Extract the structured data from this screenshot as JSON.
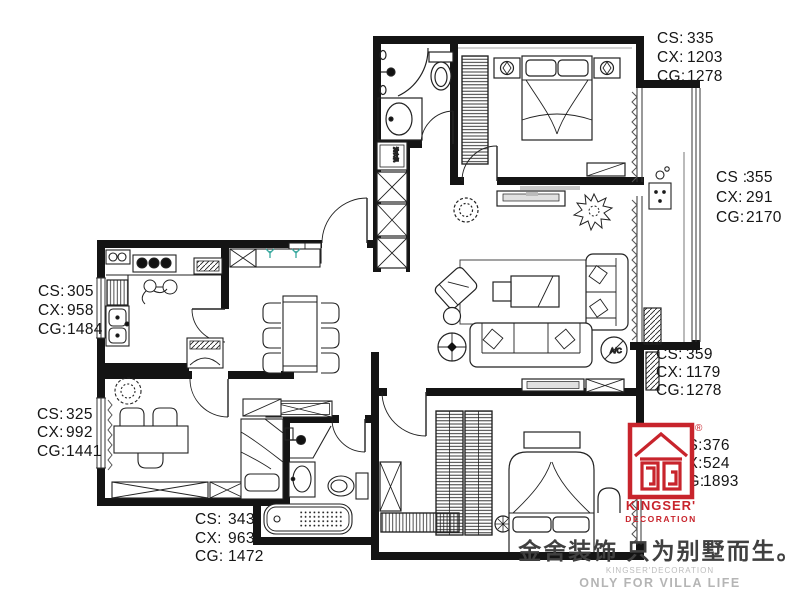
{
  "brand": {
    "registered_mark": "®",
    "logo_text_1": "KINGSER'",
    "logo_text_2": "DECORATION",
    "slogan_cn": "金舍装饰 只为别墅而生。",
    "slogan_en_1": "KINGSER'DECORATION",
    "slogan_en_2": "ONLY FOR VILLA LIFE"
  },
  "dimension_labels": {
    "top_right": {
      "row1_key": "CS:",
      "row1_val": "335",
      "row2_key": "CX:",
      "row2_val": "1203",
      "row3_key": "CG:",
      "row3_val": "1278"
    },
    "right_upper": {
      "row1_key": "CS :",
      "row1_val": "355",
      "row2_key": "CX:",
      "row2_val": "291",
      "row3_key": "CG:",
      "row3_val": "2170"
    },
    "right_lower": {
      "row1_key": "CS:",
      "row1_val": "359",
      "row2_key": "CX:",
      "row2_val": "1179",
      "row3_key": "CG:",
      "row3_val": "1278"
    },
    "logo_side": {
      "row1_key": "CS:",
      "row1_val": "376",
      "row2_key": "CX:",
      "row2_val": "524",
      "row3_key": "CG:",
      "row3_val": "1893"
    },
    "left_upper": {
      "row1_key": "CS:",
      "row1_val": "305",
      "row2_key": "CX:",
      "row2_val": "958",
      "row3_key": "CG:",
      "row3_val": "1484"
    },
    "left_lower": {
      "row1_key": "CS:",
      "row1_val": "325",
      "row2_key": "CX:",
      "row2_val": "992",
      "row3_key": "CG:",
      "row3_val": "1441"
    },
    "bottom": {
      "row1_key": "CS:",
      "row1_val": "343",
      "row2_key": "CX:",
      "row2_val": "963",
      "row3_key": "CG:",
      "row3_val": "1472"
    }
  },
  "plan_annotations": {
    "ac_label": "A/C",
    "washer_label": "洗衣机"
  },
  "colors": {
    "wall": "#141414",
    "line": "#222222",
    "logo_red": "#c8242c",
    "slogan_dark": "#404040",
    "slogan_light": "#b5b5b5",
    "plant_green": "#3aa99f",
    "tv_gray": "#c9c9c9"
  }
}
